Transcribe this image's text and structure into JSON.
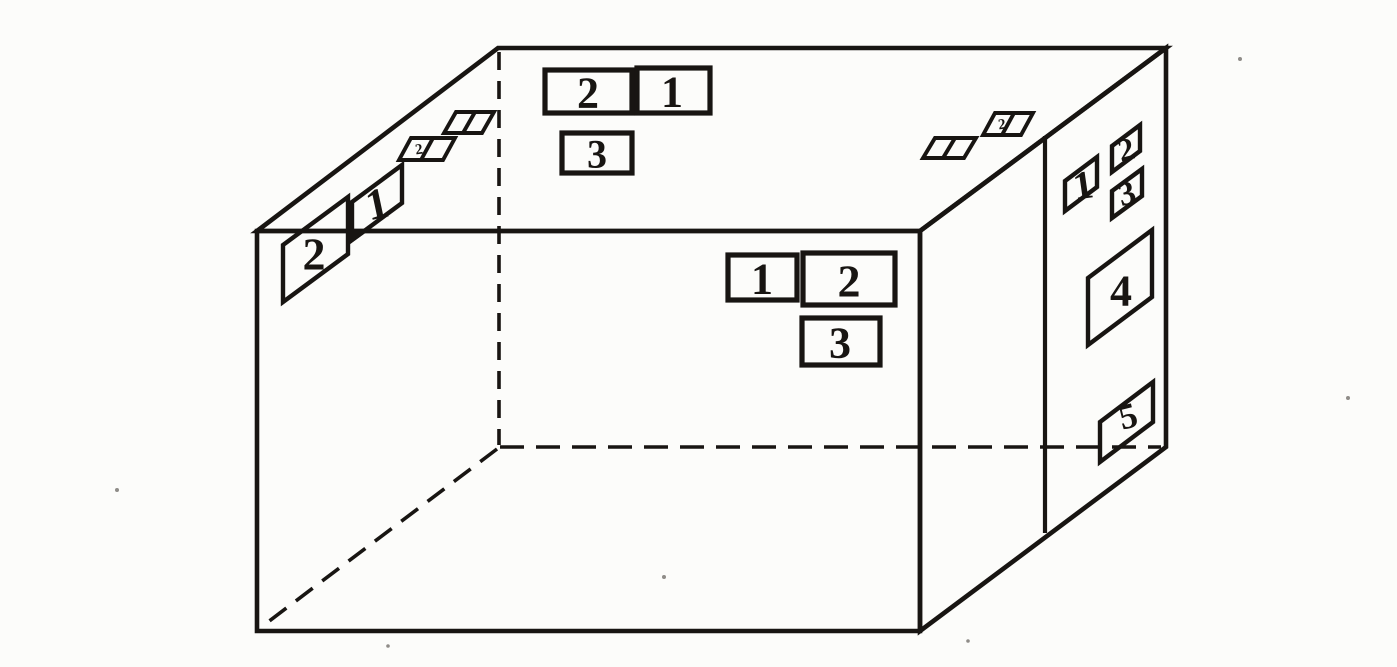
{
  "theme": {
    "ink": "#181512",
    "paper": "#fcfcfa"
  },
  "labels": {
    "top_face": [
      {
        "id": "top-label-2",
        "text": "2"
      },
      {
        "id": "top-label-1",
        "text": "1"
      },
      {
        "id": "top-label-3",
        "text": "3"
      }
    ],
    "left_edge": [
      {
        "id": "left-edge-label-2",
        "text": "2"
      },
      {
        "id": "left-edge-label-1",
        "text": "1"
      }
    ],
    "front_face": [
      {
        "id": "front-label-1",
        "text": "1"
      },
      {
        "id": "front-label-2",
        "text": "2"
      },
      {
        "id": "front-label-3",
        "text": "3"
      }
    ],
    "right_face": [
      {
        "id": "right-label-1",
        "text": "1"
      },
      {
        "id": "right-label-2",
        "text": "2"
      },
      {
        "id": "right-label-3",
        "text": "3"
      },
      {
        "id": "right-label-4",
        "text": "4"
      },
      {
        "id": "right-label-5",
        "text": "5"
      }
    ],
    "mini_marks": [
      {
        "id": "mini-mark-left-lower",
        "text": "2"
      },
      {
        "id": "mini-mark-right-upper",
        "text": "2"
      }
    ]
  }
}
